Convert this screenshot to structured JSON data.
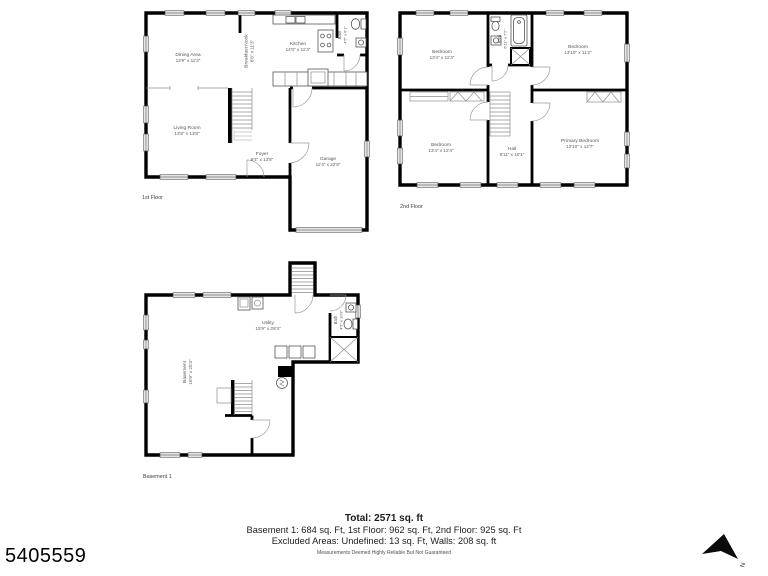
{
  "floors": {
    "first": {
      "label": "1st Floor",
      "rooms": {
        "dining": {
          "name": "Dining Area",
          "dims": "13'9\" x 11'3\""
        },
        "nook": {
          "name": "Breakfast Nook",
          "dims": "6'8\" x 11'3\""
        },
        "kitchen": {
          "name": "Kitchen",
          "dims": "14'0\" x 11'3\""
        },
        "bath": {
          "name": "Bath",
          "dims": "4'5\" x 6'1\""
        },
        "living": {
          "name": "Living Room",
          "dims": "13'8\" x 13'8\""
        },
        "foyer": {
          "name": "Foyer",
          "dims": "9'4\" x 13'8\""
        },
        "garage": {
          "name": "Garage",
          "dims": "11'4\" x 22'8\""
        }
      }
    },
    "second": {
      "label": "2nd Floor",
      "rooms": {
        "bedroom_tl": {
          "name": "Bedroom",
          "dims": "13'4\" x 11'3\""
        },
        "bath": {
          "name": "Bath",
          "dims": "6'11\" x 7'2\""
        },
        "bedroom_tr": {
          "name": "Bedroom",
          "dims": "13'10\" x 11'2\""
        },
        "bedroom_bl": {
          "name": "Bedroom",
          "dims": "13'4\" x 12'4\""
        },
        "hall": {
          "name": "Hall",
          "dims": "6'11\" x 10'1\""
        },
        "primary": {
          "name": "Primary Bedroom",
          "dims": "13'10\" x 12'7\""
        }
      }
    },
    "basement": {
      "label": "Basement 1",
      "rooms": {
        "utility": {
          "name": "Utility",
          "dims": "15'9\" x 29'3\""
        },
        "basement": {
          "name": "Basement",
          "dims": "16'9\" x 25'3\""
        },
        "bath": {
          "name": "Bath",
          "dims": "4'5\" x 10'9\""
        }
      }
    }
  },
  "summary": {
    "total": "Total: 2571 sq. ft",
    "line1": "Basement 1: 684 sq. Ft, 1st Floor: 962 sq. Ft, 2nd Floor: 925 sq. Ft",
    "line2": "Excluded Areas: Undefined: 13 sq. Ft, Walls: 208 sq. ft",
    "disclaimer": "Measurements Deemed Highly Reliable But Not Guaranteed"
  },
  "listing_id": "5405559",
  "compass": {
    "label": "N"
  },
  "colors": {
    "wall": "#000000",
    "label_gray": "#565656",
    "background": "#ffffff"
  }
}
